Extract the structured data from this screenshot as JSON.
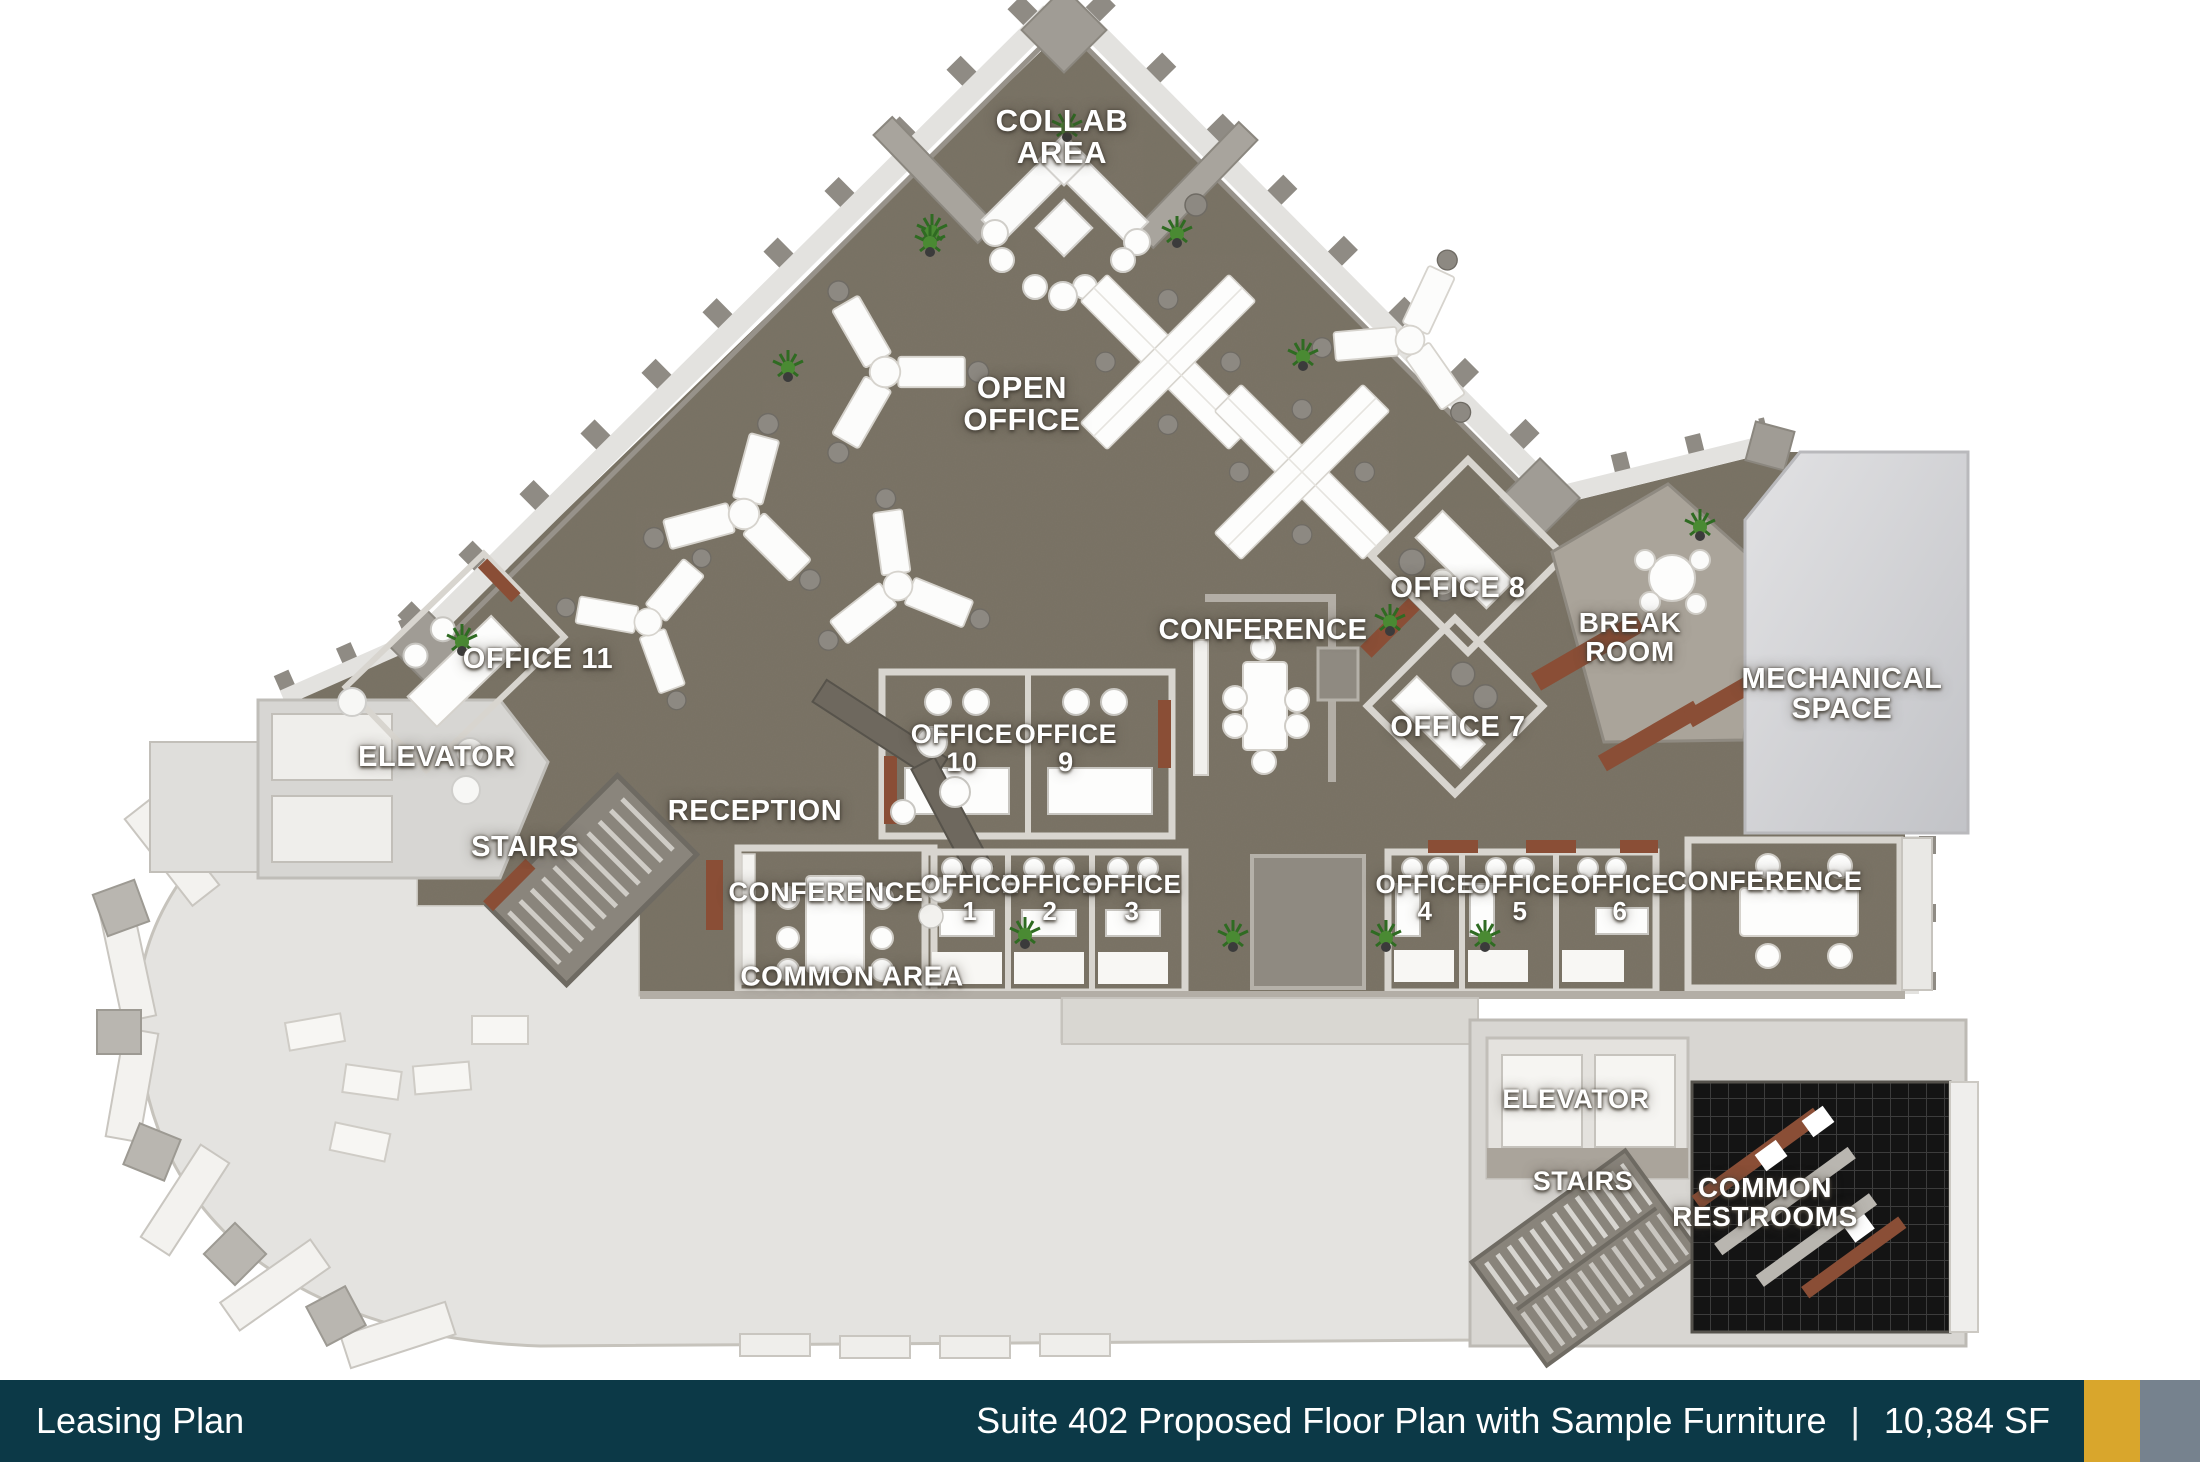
{
  "footer": {
    "left_title": "Leasing Plan",
    "right_title": "Suite 402  Proposed Floor Plan with Sample Furniture",
    "separator": "|",
    "area": "10,384 SF",
    "bar_color": "#0c3947",
    "accent_gold": "#d9a62c",
    "accent_gray": "#76828e"
  },
  "plan": {
    "colors": {
      "carpet": "#7b7466",
      "shell_floor": "#e4e3e0",
      "wall_light": "#dedbd4",
      "wall_dark": "#a39e95",
      "wood_accent": "#8a4e36",
      "restroom_tile": "#141414",
      "desk_white": "#fdfdfc"
    },
    "labels": [
      {
        "id": "collab-area",
        "text": "COLLAB\nAREA"
      },
      {
        "id": "open-office",
        "text": "OPEN\nOFFICE"
      },
      {
        "id": "office-8",
        "text": "OFFICE 8"
      },
      {
        "id": "conference-middle",
        "text": "CONFERENCE"
      },
      {
        "id": "break-room",
        "text": "BREAK\nROOM"
      },
      {
        "id": "mechanical-space",
        "text": "MECHANICAL\nSPACE"
      },
      {
        "id": "office-11",
        "text": "OFFICE 11"
      },
      {
        "id": "elevator-left",
        "text": "ELEVATOR"
      },
      {
        "id": "office-10",
        "text": "OFFICE\n10"
      },
      {
        "id": "office-9",
        "text": "OFFICE\n9"
      },
      {
        "id": "office-7",
        "text": "OFFICE 7"
      },
      {
        "id": "reception",
        "text": "RECEPTION"
      },
      {
        "id": "stairs-left",
        "text": "STAIRS"
      },
      {
        "id": "conference-left",
        "text": "CONFERENCE"
      },
      {
        "id": "office-1",
        "text": "OFFICE\n1"
      },
      {
        "id": "office-2",
        "text": "OFFICE\n2"
      },
      {
        "id": "office-3",
        "text": "OFFICE\n3"
      },
      {
        "id": "common-area",
        "text": "COMMON AREA"
      },
      {
        "id": "office-4",
        "text": "OFFICE\n4"
      },
      {
        "id": "office-5",
        "text": "OFFICE\n5"
      },
      {
        "id": "office-6",
        "text": "OFFICE\n6"
      },
      {
        "id": "conference-right",
        "text": "CONFERENCE"
      },
      {
        "id": "elevator-bottom",
        "text": "ELEVATOR"
      },
      {
        "id": "stairs-bottom",
        "text": "STAIRS"
      },
      {
        "id": "common-restrooms",
        "text": "COMMON\nRESTROOMS"
      }
    ]
  }
}
